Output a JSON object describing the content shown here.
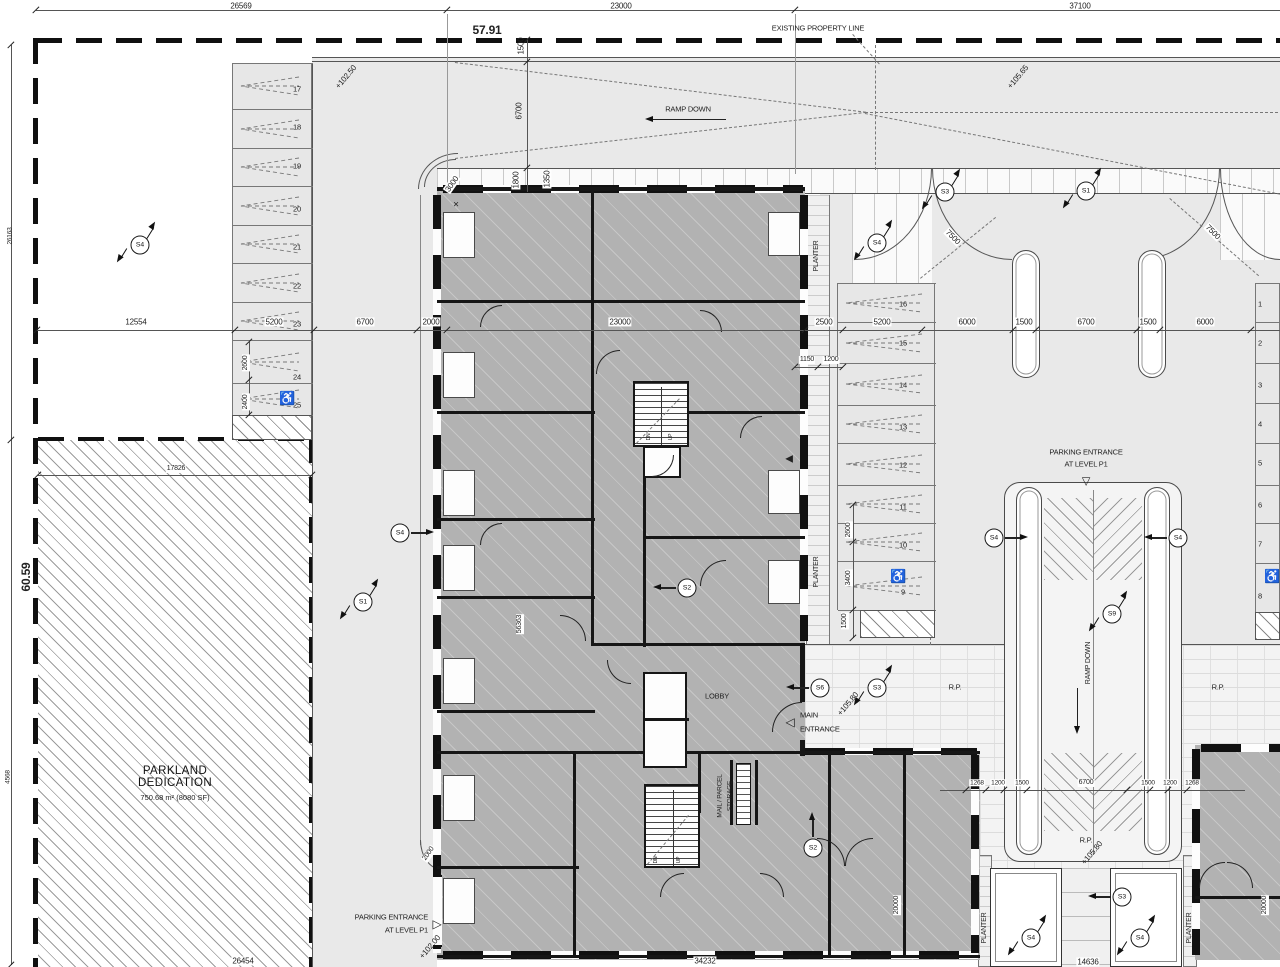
{
  "parkland": {
    "title": "PARKLAND\nDEDICATION",
    "area": "750.68 m² (8080 SF)"
  },
  "parking": {
    "left_stall_numbers": [
      "17",
      "18",
      "19",
      "20",
      "21",
      "22",
      "23",
      "24",
      "25"
    ],
    "middle_stall_numbers": [
      "16",
      "15",
      "14",
      "13",
      "12",
      "11",
      "10",
      "9"
    ],
    "right_stall_numbers": [
      "1",
      "2",
      "3",
      "4",
      "5",
      "6",
      "7",
      "8"
    ],
    "accessible_icon": "♿"
  },
  "section_markers": [
    {
      "t": "S4",
      "x": 140,
      "y": 245,
      "k": "f"
    },
    {
      "t": "S3",
      "x": 945,
      "y": 192,
      "k": "f"
    },
    {
      "t": "S1",
      "x": 1086,
      "y": 191,
      "k": "f"
    },
    {
      "t": "S4",
      "x": 877,
      "y": 243,
      "k": "f"
    },
    {
      "t": "S4",
      "x": 400,
      "y": 533,
      "k": "a",
      "d": "r"
    },
    {
      "t": "S1",
      "x": 363,
      "y": 602,
      "k": "f"
    },
    {
      "t": "S4",
      "x": 994,
      "y": 538,
      "k": "a",
      "d": "r"
    },
    {
      "t": "S4",
      "x": 1178,
      "y": 538,
      "k": "a",
      "d": "l"
    },
    {
      "t": "S9",
      "x": 1112,
      "y": 614,
      "k": "f"
    },
    {
      "t": "S6",
      "x": 820,
      "y": 688,
      "k": "a",
      "d": "l"
    },
    {
      "t": "S3",
      "x": 877,
      "y": 688,
      "k": "f"
    },
    {
      "t": "S2",
      "x": 687,
      "y": 588,
      "k": "a",
      "d": "l"
    },
    {
      "t": "S2",
      "x": 813,
      "y": 848,
      "k": "a",
      "d": "u"
    },
    {
      "t": "S3",
      "x": 1122,
      "y": 897,
      "k": "a",
      "d": "l"
    },
    {
      "t": "S4",
      "x": 1031,
      "y": 938,
      "k": "f"
    },
    {
      "t": "S4",
      "x": 1140,
      "y": 938,
      "k": "f"
    }
  ],
  "annotations": [
    {
      "t": "26569",
      "x": 241,
      "y": 6
    },
    {
      "t": "23000",
      "x": 621,
      "y": 6
    },
    {
      "t": "37100",
      "x": 1080,
      "y": 6
    },
    {
      "t": "57.91",
      "x": 487,
      "y": 31,
      "s": 12,
      "b": 1,
      "n": "elevation-benchmark"
    },
    {
      "t": "EXISTING PROPERTY LINE",
      "x": 818,
      "y": 29,
      "s": 7.5,
      "n": "property-line-label"
    },
    {
      "t": "RAMP DOWN",
      "x": 688,
      "y": 110,
      "s": 7.5,
      "n": "ramp-down-label"
    },
    {
      "t": "+102.50",
      "x": 346,
      "y": 77,
      "r": -50
    },
    {
      "t": "+105.65",
      "x": 1018,
      "y": 77,
      "r": -50
    },
    {
      "t": "1500",
      "x": 521,
      "y": 46,
      "r": -90
    },
    {
      "t": "6700",
      "x": 519,
      "y": 111,
      "r": -90
    },
    {
      "t": "1800",
      "x": 516,
      "y": 180,
      "r": -90,
      "bg": 1
    },
    {
      "t": "1350",
      "x": 547,
      "y": 179,
      "r": -90,
      "bg": 1
    },
    {
      "t": "3000",
      "x": 452,
      "y": 184,
      "r": -55,
      "bg": 1
    },
    {
      "t": "26163",
      "x": 10,
      "y": 236,
      "r": -90,
      "s": 6.5
    },
    {
      "t": "60.59",
      "x": 27,
      "y": 577,
      "r": -90,
      "s": 12,
      "b": 1,
      "n": "elevation-benchmark"
    },
    {
      "t": "4568",
      "x": 8,
      "y": 777,
      "r": -90,
      "s": 6.5
    },
    {
      "t": "17826",
      "x": 176,
      "y": 469,
      "bg": 1,
      "s": 7
    },
    {
      "t": "12554",
      "x": 136,
      "y": 322,
      "bg": 1
    },
    {
      "t": "5200",
      "x": 274,
      "y": 322,
      "bg": 1
    },
    {
      "t": "6700",
      "x": 365,
      "y": 322,
      "bg": 1
    },
    {
      "t": "2000",
      "x": 431,
      "y": 322,
      "bg": 1
    },
    {
      "t": "23000",
      "x": 620,
      "y": 322,
      "bg": 1
    },
    {
      "t": "2500",
      "x": 824,
      "y": 322,
      "bg": 1
    },
    {
      "t": "5200",
      "x": 882,
      "y": 322,
      "bg": 1
    },
    {
      "t": "6000",
      "x": 967,
      "y": 322,
      "bg": 1
    },
    {
      "t": "1500",
      "x": 1024,
      "y": 322,
      "bg": 1
    },
    {
      "t": "6700",
      "x": 1086,
      "y": 322,
      "bg": 1
    },
    {
      "t": "1500",
      "x": 1148,
      "y": 322,
      "bg": 1
    },
    {
      "t": "6000",
      "x": 1205,
      "y": 322,
      "bg": 1
    },
    {
      "t": "1150",
      "x": 807,
      "y": 360,
      "bg": 1,
      "s": 7
    },
    {
      "t": "1200",
      "x": 831,
      "y": 360,
      "bg": 1,
      "s": 7
    },
    {
      "t": "2600",
      "x": 246,
      "y": 363,
      "r": -90,
      "bg": 1,
      "s": 7
    },
    {
      "t": "2400",
      "x": 246,
      "y": 402,
      "r": -90,
      "bg": 1,
      "s": 7
    },
    {
      "t": "2600",
      "x": 849,
      "y": 530,
      "r": -90,
      "bg": 1,
      "s": 7
    },
    {
      "t": "3400",
      "x": 849,
      "y": 578,
      "r": -90,
      "bg": 1,
      "s": 7
    },
    {
      "t": "1500",
      "x": 845,
      "y": 621,
      "r": -90,
      "bg": 1,
      "s": 7
    },
    {
      "t": "7500",
      "x": 953,
      "y": 237,
      "r": 45,
      "bg": 1
    },
    {
      "t": "7500",
      "x": 1213,
      "y": 232,
      "r": 45,
      "bg": 1
    },
    {
      "t": "PARKING ENTRANCE",
      "x": 1086,
      "y": 453,
      "s": 7.5,
      "n": "parking-entrance-label"
    },
    {
      "t": "AT LEVEL P1",
      "x": 1086,
      "y": 465,
      "s": 7.5,
      "n": "parking-entrance-label"
    },
    {
      "t": "▽",
      "x": 1086,
      "y": 482,
      "s": 11,
      "n": "entrance-arrow"
    },
    {
      "t": "PLANTER",
      "x": 817,
      "y": 256,
      "r": -90,
      "s": 7,
      "n": "planter-label"
    },
    {
      "t": "PLANTER",
      "x": 817,
      "y": 572,
      "r": -90,
      "s": 7,
      "n": "planter-label"
    },
    {
      "t": "PLANTER",
      "x": 985,
      "y": 928,
      "r": -90,
      "s": 7,
      "n": "planter-label"
    },
    {
      "t": "PLANTER",
      "x": 1190,
      "y": 928,
      "r": -90,
      "s": 7,
      "n": "planter-label"
    },
    {
      "t": "56363",
      "x": 520,
      "y": 624,
      "r": -90,
      "bg": 1,
      "s": 7
    },
    {
      "t": "LOBBY",
      "x": 717,
      "y": 697,
      "s": 7.5,
      "n": "lobby-label"
    },
    {
      "t": "MAIN",
      "x": 800,
      "y": 716,
      "al": "l",
      "s": 7.5,
      "n": "main-entrance-label"
    },
    {
      "t": "ENTRANCE",
      "x": 800,
      "y": 730,
      "al": "l",
      "s": 7.5,
      "n": "main-entrance-label"
    },
    {
      "t": "◁",
      "x": 790,
      "y": 723,
      "s": 12,
      "n": "entrance-arrow"
    },
    {
      "t": "MAIL / PARCEL",
      "x": 720,
      "y": 796,
      "r": -90,
      "s": 6.5,
      "n": "mail-parcel-label"
    },
    {
      "t": "STORAGE",
      "x": 730,
      "y": 796,
      "r": -90,
      "s": 6.5,
      "n": "mail-parcel-label"
    },
    {
      "t": "R.P.",
      "x": 955,
      "y": 688,
      "s": 7.5,
      "n": "rp-label"
    },
    {
      "t": "R.P.",
      "x": 1218,
      "y": 688,
      "s": 7.5,
      "n": "rp-label"
    },
    {
      "t": "R.P.",
      "x": 1086,
      "y": 841,
      "s": 7.5,
      "n": "rp-label"
    },
    {
      "t": "RAMP DOWN",
      "x": 1089,
      "y": 663,
      "r": -90,
      "s": 7,
      "n": "ramp-down-label"
    },
    {
      "t": "+105.80",
      "x": 848,
      "y": 704,
      "r": -50
    },
    {
      "t": "+105.80",
      "x": 1092,
      "y": 853,
      "r": -50
    },
    {
      "t": "1268",
      "x": 977,
      "y": 783,
      "bg": 1,
      "s": 6.5
    },
    {
      "t": "1200",
      "x": 998,
      "y": 783,
      "bg": 1,
      "s": 6.5
    },
    {
      "t": "1500",
      "x": 1022,
      "y": 783,
      "bg": 1,
      "s": 6.5
    },
    {
      "t": "6700",
      "x": 1086,
      "y": 783,
      "bg": 1,
      "s": 7
    },
    {
      "t": "1500",
      "x": 1148,
      "y": 783,
      "bg": 1,
      "s": 6.5
    },
    {
      "t": "1200",
      "x": 1170,
      "y": 783,
      "bg": 1,
      "s": 6.5
    },
    {
      "t": "1268",
      "x": 1192,
      "y": 783,
      "bg": 1,
      "s": 6.5
    },
    {
      "t": "PARKING ENTRANCE",
      "x": 428,
      "y": 918,
      "al": "r",
      "s": 7.5,
      "n": "parking-entrance-label"
    },
    {
      "t": "AT LEVEL P1",
      "x": 428,
      "y": 931,
      "al": "r",
      "s": 7.5,
      "n": "parking-entrance-label"
    },
    {
      "t": "▷",
      "x": 437,
      "y": 925,
      "s": 12,
      "n": "entrance-arrow"
    },
    {
      "t": "+102.00",
      "x": 430,
      "y": 947,
      "r": -50
    },
    {
      "t": "2000",
      "x": 429,
      "y": 854,
      "r": -55,
      "bg": 1,
      "s": 7
    },
    {
      "t": "20000",
      "x": 897,
      "y": 905,
      "r": -90,
      "bg": 1,
      "s": 7
    },
    {
      "t": "20000",
      "x": 1265,
      "y": 905,
      "r": -90,
      "bg": 1,
      "s": 7
    },
    {
      "t": "14636",
      "x": 1088,
      "y": 962,
      "bg": 1
    },
    {
      "t": "26454",
      "x": 243,
      "y": 961,
      "bg": 1
    },
    {
      "t": "34232",
      "x": 705,
      "y": 961,
      "bg": 1
    },
    {
      "t": "◀",
      "x": 789,
      "y": 459,
      "s": 10,
      "n": "door-wedge"
    },
    {
      "t": "×",
      "x": 456,
      "y": 205,
      "s": 10
    },
    {
      "t": "♿",
      "x": 287,
      "y": 399,
      "s": 13,
      "n": "accessible-parking-icon"
    },
    {
      "t": "♿",
      "x": 898,
      "y": 577,
      "s": 13,
      "n": "accessible-parking-icon"
    },
    {
      "t": "♿",
      "x": 1272,
      "y": 577,
      "s": 13,
      "n": "accessible-parking-icon"
    },
    {
      "t": "DN",
      "x": 650,
      "y": 437,
      "s": 5,
      "r": -90
    },
    {
      "t": "UP",
      "x": 672,
      "y": 437,
      "s": 5,
      "r": -90
    },
    {
      "t": "DN",
      "x": 657,
      "y": 860,
      "s": 5,
      "r": -90
    },
    {
      "t": "UP",
      "x": 680,
      "y": 860,
      "s": 5,
      "r": -90
    }
  ]
}
